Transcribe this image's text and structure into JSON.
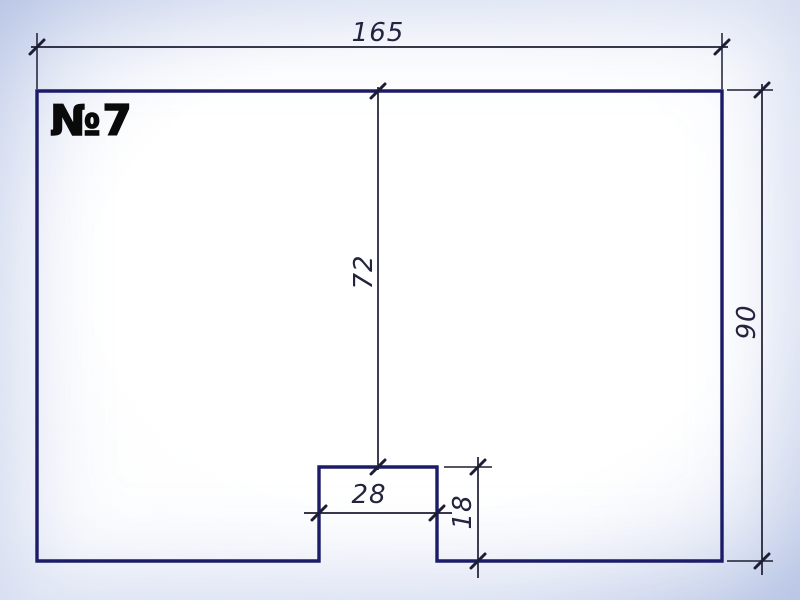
{
  "drawing": {
    "label": "№7",
    "dimensions": {
      "top_width": "165",
      "right_height": "90",
      "center_vertical": "72",
      "notch_width": "28",
      "notch_height": "18"
    },
    "colors": {
      "outline_color": "#1b1b68",
      "dim_color": "#1d1d33",
      "text_color": "#23233d",
      "label_color": "#0a0a0a",
      "bg_center": "#ffffff",
      "bg_edge": "#ccd6ec"
    }
  }
}
